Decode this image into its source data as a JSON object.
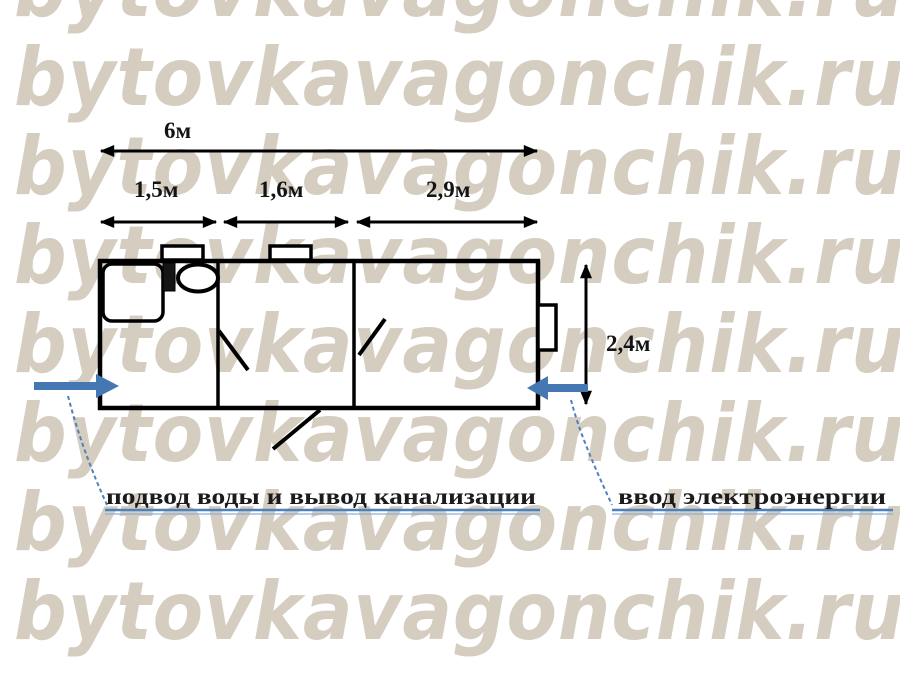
{
  "watermark": {
    "text": "bytovkavagonchik.ru",
    "color": "#d5cdc0",
    "rows": 8
  },
  "dimensions": {
    "total_length": "6м",
    "section1": "1,5м",
    "section2": "1,6м",
    "section3": "2,9м",
    "height": "2,4м"
  },
  "labels": {
    "water": "подвод воды и вывод канализации",
    "electricity": "ввод электроэнергии"
  },
  "colors": {
    "accent_blue": "#4f81bd",
    "arrow_blue": "#4577b3",
    "line_black": "#000000",
    "watermark_beige": "#d5cdc0"
  }
}
